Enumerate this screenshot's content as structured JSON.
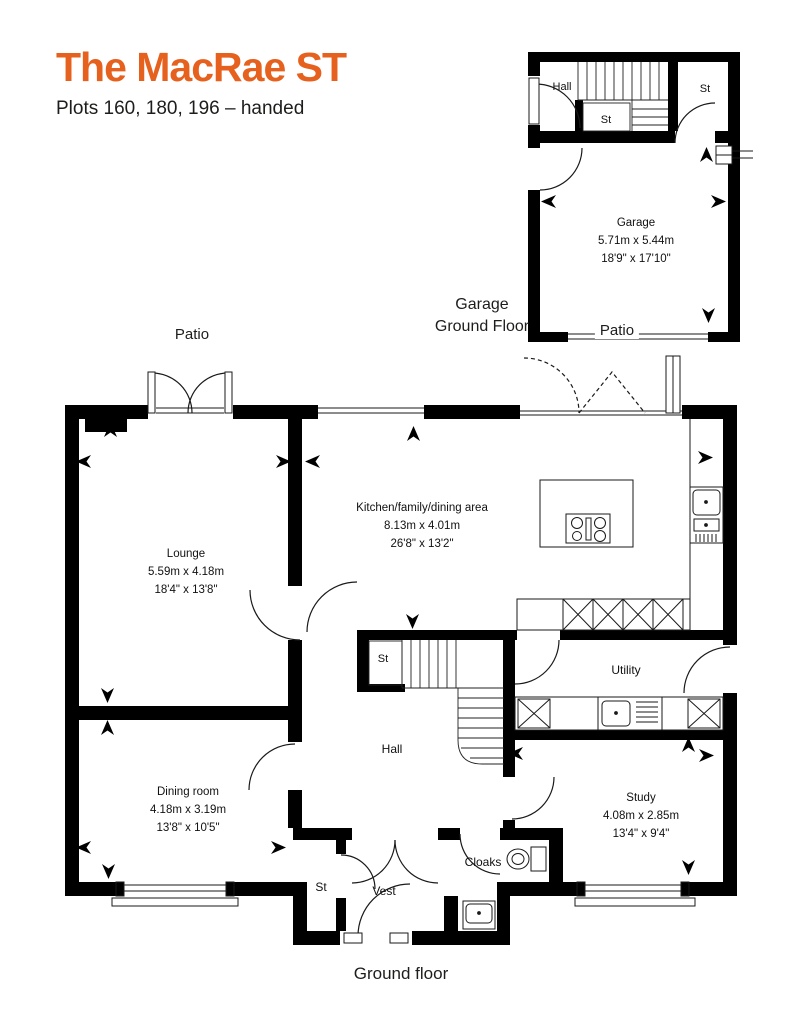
{
  "header": {
    "title": "The MacRae ST",
    "subtitle": "Plots 160, 180, 196 – handed"
  },
  "colors": {
    "accent": "#E6601E",
    "wall": "#000000",
    "text": "#1D1D1B"
  },
  "garage_plan": {
    "caption": {
      "line1": "Garage",
      "line2": "Ground Floor"
    },
    "patio_label": "Patio",
    "rooms": {
      "hall": {
        "name": "Hall"
      },
      "stairs_store": {
        "name": "St"
      },
      "store": {
        "name": "St"
      },
      "garage": {
        "name": "Garage",
        "metric": "5.71m x 5.44m",
        "imperial": "18'9\" x 17'10\""
      }
    }
  },
  "main_plan": {
    "patio_label": "Patio",
    "caption": "Ground floor",
    "rooms": {
      "lounge": {
        "name": "Lounge",
        "metric": "5.59m x 4.18m",
        "imperial": "18'4\" x 13'8\""
      },
      "kitchen": {
        "name": "Kitchen/family/dining area",
        "metric": "8.13m x 4.01m",
        "imperial": "26'8\" x 13'2\""
      },
      "utility": {
        "name": "Utility"
      },
      "hall": {
        "name": "Hall"
      },
      "stairs_store": {
        "name": "St"
      },
      "dining": {
        "name": "Dining room",
        "metric": "4.18m x 3.19m",
        "imperial": "13'8\" x 10'5\""
      },
      "study": {
        "name": "Study",
        "metric": "4.08m x 2.85m",
        "imperial": "13'4\" x 9'4\""
      },
      "cloaks": {
        "name": "Cloaks"
      },
      "vest": {
        "name": "Vest"
      },
      "store": {
        "name": "St"
      }
    }
  }
}
